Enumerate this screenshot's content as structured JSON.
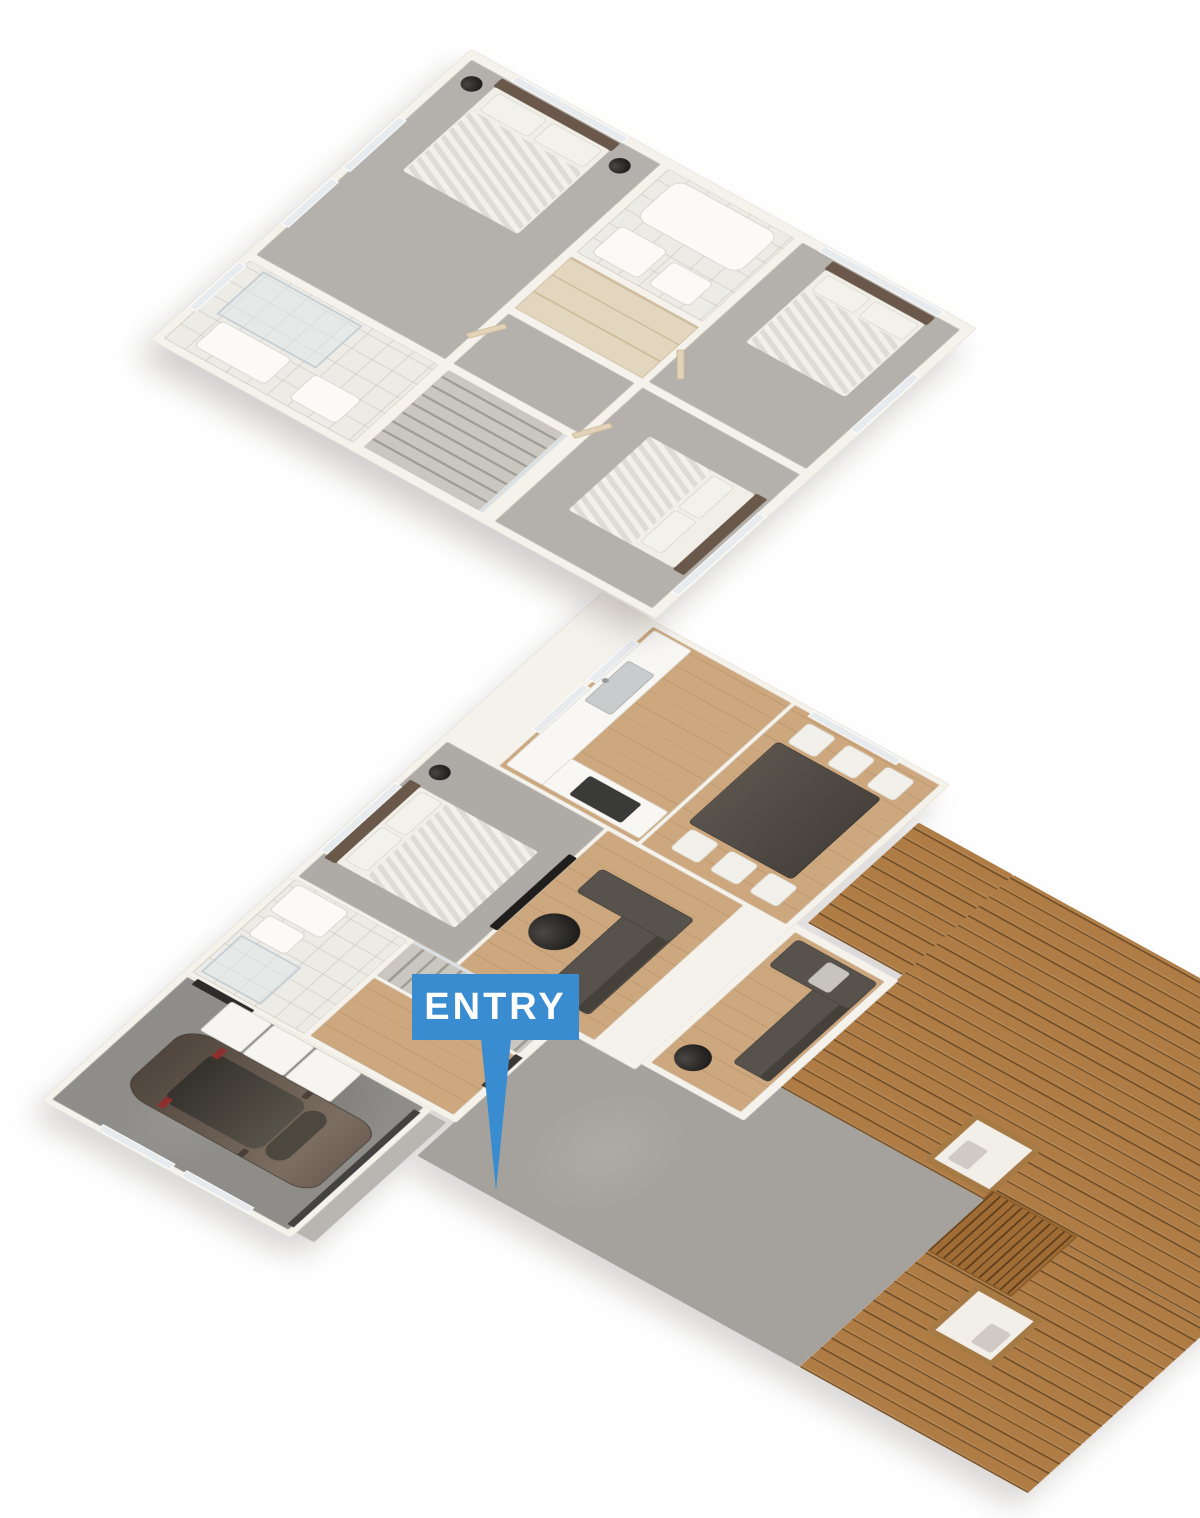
{
  "scene": {
    "type": "isometric-3d-floor-plan",
    "view": "axonometric dollhouse cutaway, two storeys stacked vertically",
    "storeys": 2,
    "background_color": "#ffffff"
  },
  "marker": {
    "text": "ENTRY",
    "background_color": "#3a8cd0",
    "text_color": "#ffffff",
    "shape": "rectangular flag with long tapered downward pointer to the front door"
  },
  "palette": {
    "accent_blue": "#3a8cd0",
    "wall": "#f5f2ec",
    "carpet_gray": "#b4b1ad",
    "tile_white": "#edebe6",
    "timber_floor": "#cda87e",
    "deck_board": "#ae7c44",
    "concrete_gray": "#8f8d89",
    "sofa_gray": "#57524c",
    "duvet_taupe": "#84715d",
    "headboard_brown": "#6a594a",
    "coffee_table_black": "#201f1d",
    "joinery_beige": "#e3d6bf",
    "car_body": "#685b50"
  },
  "upper_floor": {
    "label": "upper-floor",
    "rooms": [
      {
        "name": "ensuite-bathroom",
        "furniture": [
          "walk-in-shower",
          "toilet",
          "vanity"
        ]
      },
      {
        "name": "master-bedroom",
        "furniture": [
          "double-bed",
          "pillows",
          "bedside-tables",
          "tall-windows"
        ]
      },
      {
        "name": "hallway",
        "furniture": [
          "built-in-wardrobes",
          "glass-balustrade"
        ]
      },
      {
        "name": "staircase",
        "furniture": [
          "stairs-down"
        ]
      },
      {
        "name": "bathroom",
        "furniture": [
          "bathtub",
          "vanity",
          "toilet"
        ]
      },
      {
        "name": "bedroom-2",
        "furniture": [
          "double-bed",
          "pillows",
          "windows"
        ]
      },
      {
        "name": "bedroom-3",
        "furniture": [
          "double-bed",
          "pillows",
          "door"
        ]
      }
    ]
  },
  "lower_floor": {
    "label": "ground-floor",
    "rooms": [
      {
        "name": "garage",
        "furniture": [
          "car",
          "washing-machine",
          "dryer",
          "laundry-cabinet",
          "garage-door",
          "windows"
        ]
      },
      {
        "name": "bathroom",
        "furniture": [
          "shower",
          "toilet",
          "vanity"
        ]
      },
      {
        "name": "hall-mudroom",
        "furniture": [
          "front-door",
          "internal-door"
        ]
      },
      {
        "name": "staircase",
        "furniture": [
          "stairs-up",
          "glass-balustrade"
        ]
      },
      {
        "name": "bedroom-4",
        "furniture": [
          "double-bed",
          "pillows",
          "bedside-table",
          "wall-mounted-tv"
        ]
      },
      {
        "name": "family-room",
        "furniture": [
          "corner-sofa",
          "round-coffee-table"
        ]
      },
      {
        "name": "kitchen",
        "furniture": [
          "counter",
          "double-sink",
          "faucet",
          "peninsula-bench",
          "cooktop",
          "windows"
        ]
      },
      {
        "name": "dining-room",
        "furniture": [
          "dining-table",
          "six-chairs",
          "window"
        ]
      },
      {
        "name": "lounge-sunroom",
        "furniture": [
          "corner-sofa",
          "round-side-table",
          "throw-blanket"
        ]
      },
      {
        "name": "entry-porch",
        "furniture": [
          "concrete-path"
        ]
      },
      {
        "name": "deck",
        "furniture": [
          "outdoor-armchair",
          "slatted-coffee-table",
          "outdoor-armchair"
        ]
      }
    ]
  },
  "vehicle": {
    "type": "hatchback-car",
    "color": "#685b50"
  }
}
